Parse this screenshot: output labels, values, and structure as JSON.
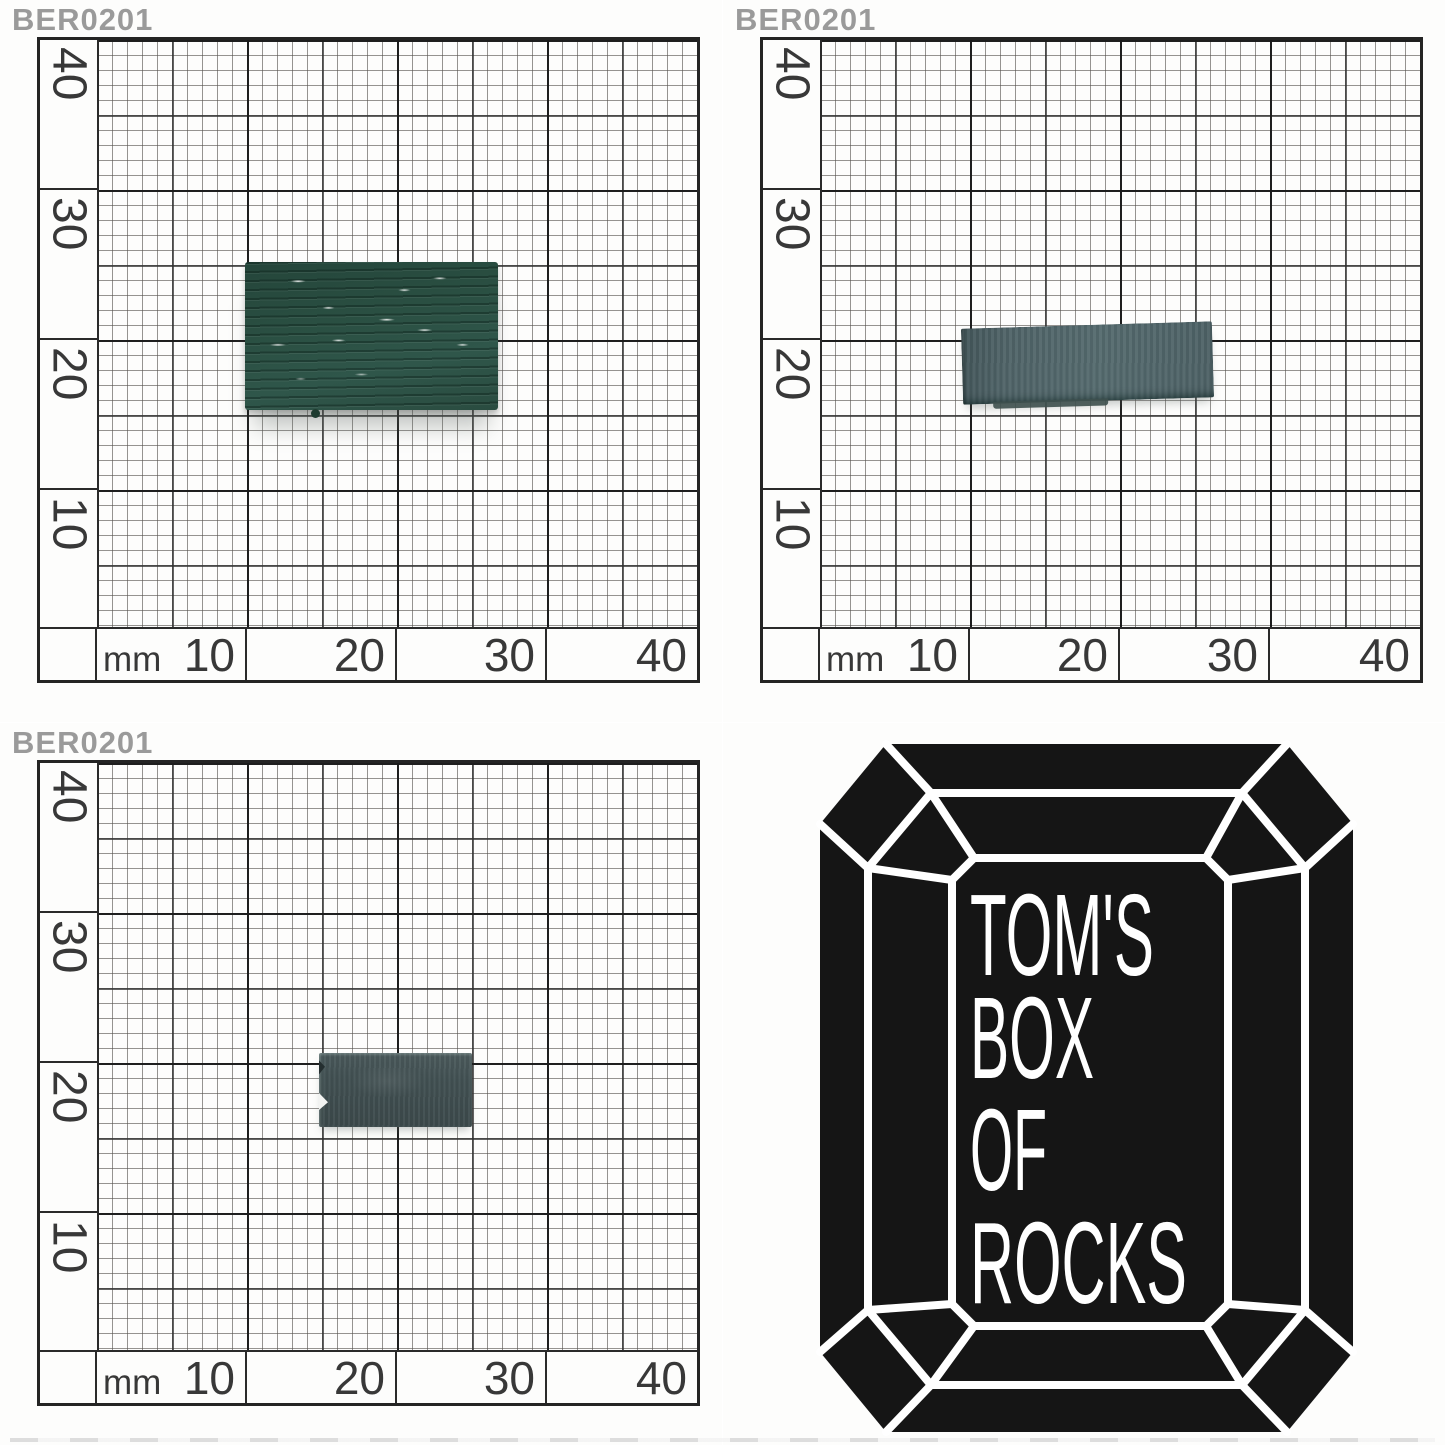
{
  "panels": {
    "top_left": {
      "id_label": "BER0201"
    },
    "top_right": {
      "id_label": "BER0201"
    },
    "bottom_left": {
      "id_label": "BER0201"
    }
  },
  "ruler": {
    "unit": "mm",
    "x_ticks": [
      "10",
      "20",
      "30",
      "40"
    ],
    "y_ticks": [
      "40",
      "30",
      "20",
      "10"
    ]
  },
  "specimens": {
    "top_face": {
      "color": "#2b4e41",
      "approx_width_mm": 17,
      "approx_height_mm": 10
    },
    "side_face": {
      "color": "#4f6367",
      "approx_width_mm": 17,
      "approx_height_mm": 5
    },
    "end_face": {
      "color": "#424f51",
      "approx_width_mm": 10,
      "approx_height_mm": 5
    }
  },
  "logo": {
    "lines": [
      "TOM'S",
      "BOX",
      "OF",
      "ROCKS"
    ],
    "gem_color": "#151515",
    "facet_line_color": "#ffffff"
  },
  "colors": {
    "paper": "#fdfdfc",
    "label_gray": "#9a9a9a",
    "grid_major": "#232323",
    "grid_mid": "#3c3c3c",
    "grid_fine": "#6e6e6e",
    "tick_text": "#383838"
  }
}
